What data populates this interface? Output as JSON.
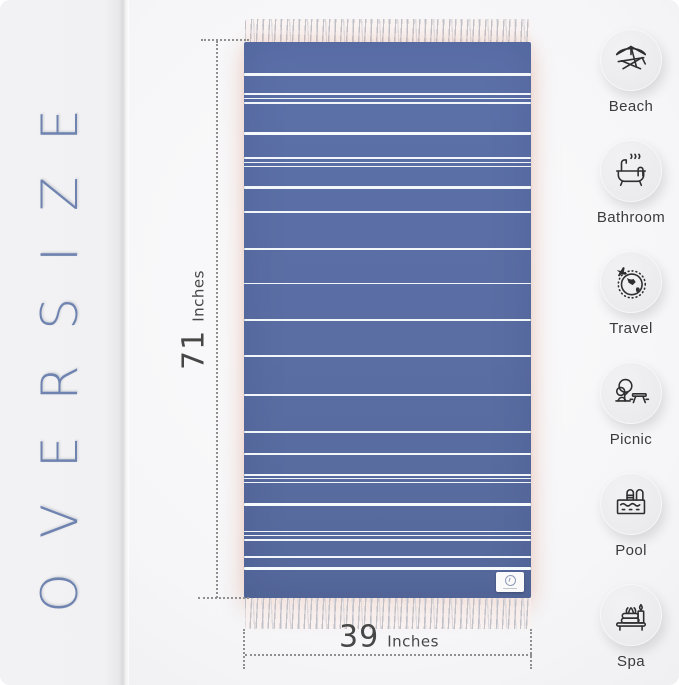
{
  "left_panel": {
    "text": "OVERSIZE"
  },
  "colors": {
    "accent_blue": "#6e83af",
    "towel_blue": "#5c70a9",
    "stripe_white": "#f3f6f9",
    "dimension_gray": "#8f8f8f",
    "label_dark": "#3b3b3b",
    "circle_gray": "#ececee",
    "background": "#f6f6f8"
  },
  "dimensions": {
    "height": {
      "value": "71",
      "unit": "Inches"
    },
    "width": {
      "value": "39",
      "unit": "Inches"
    }
  },
  "towel": {
    "stripes": [
      {
        "top": 5.6,
        "h": 2.5
      },
      {
        "top": 9.2,
        "h": 1.5
      },
      {
        "top": 10.0,
        "h": 1.2
      },
      {
        "top": 10.8,
        "h": 1.5
      },
      {
        "top": 16.2,
        "h": 3,
        "bright": true
      },
      {
        "top": 20.7,
        "h": 1.5
      },
      {
        "top": 21.5,
        "h": 1.2
      },
      {
        "top": 22.3,
        "h": 1.5
      },
      {
        "top": 25.9,
        "h": 2.5
      },
      {
        "top": 30.4,
        "h": 2
      },
      {
        "top": 37.1,
        "h": 2
      },
      {
        "top": 43.3,
        "h": 1.5
      },
      {
        "top": 49.8,
        "h": 2.5
      },
      {
        "top": 56.3,
        "h": 2
      },
      {
        "top": 63.3,
        "h": 2
      },
      {
        "top": 70.0,
        "h": 1.5
      },
      {
        "top": 73.9,
        "h": 2.5
      },
      {
        "top": 77.7,
        "h": 1.5
      },
      {
        "top": 78.4,
        "h": 1.2
      },
      {
        "top": 79.1,
        "h": 1.5
      },
      {
        "top": 82.9,
        "h": 3,
        "bright": true
      },
      {
        "top": 87.9,
        "h": 1.5
      },
      {
        "top": 88.7,
        "h": 1.2
      },
      {
        "top": 89.4,
        "h": 1.5
      },
      {
        "top": 92.4,
        "h": 2
      },
      {
        "top": 94.4,
        "h": 3,
        "bright": true
      }
    ]
  },
  "features": [
    {
      "label": "Beach",
      "icon": "beach-icon"
    },
    {
      "label": "Bathroom",
      "icon": "bathroom-icon"
    },
    {
      "label": "Travel",
      "icon": "travel-icon"
    },
    {
      "label": "Picnic",
      "icon": "picnic-icon"
    },
    {
      "label": "Pool",
      "icon": "pool-icon"
    },
    {
      "label": "Spa",
      "icon": "spa-icon"
    }
  ]
}
